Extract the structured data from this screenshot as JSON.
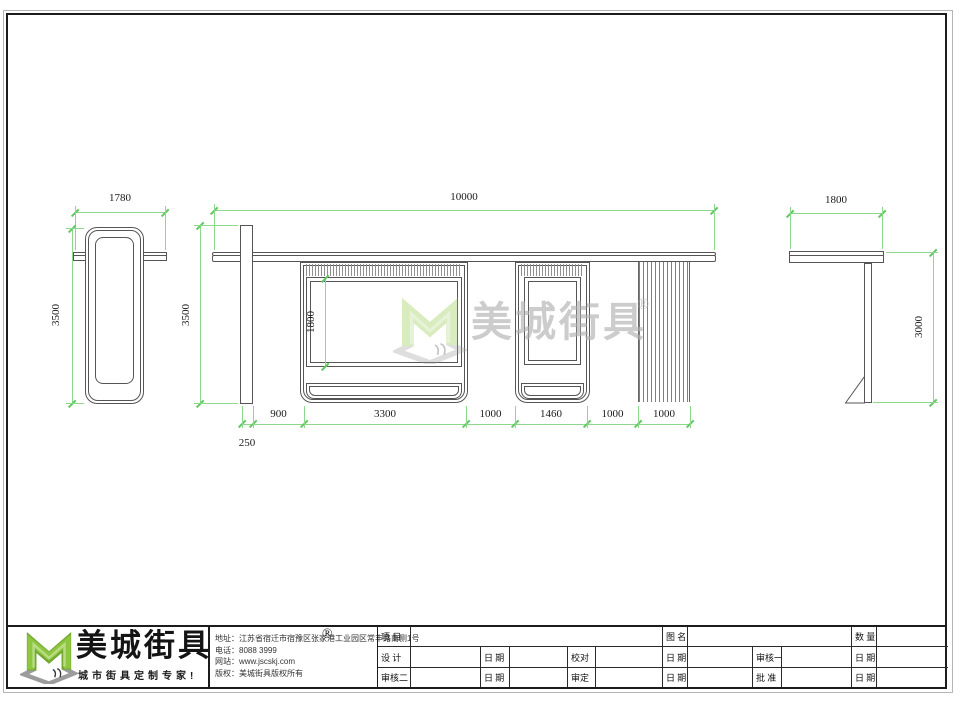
{
  "drawing": {
    "views": {
      "left": {
        "width_dim": "1780",
        "height_dim": "3500"
      },
      "front": {
        "width_dim": "10000",
        "height_dim": "3500",
        "ad_height_dim": "1800",
        "post_width_dim": "250",
        "bottom_dims": [
          "900",
          "3300",
          "1000",
          "1460",
          "1000",
          "1000"
        ]
      },
      "right": {
        "width_dim": "1800",
        "height_dim": "3000"
      }
    }
  },
  "watermark": {
    "brand": "美城街具",
    "reg": "®"
  },
  "footer": {
    "brand": "美城街具",
    "reg": "®",
    "tagline": "城市街具定制专家!",
    "contact_lines": [
      "地址：江苏省宿迁市宿豫区张家港工业园区常丰路南侧1号",
      "电话：8088 3999",
      "网站：www.jscskj.com",
      "版权：美城街具版权所有"
    ]
  },
  "titleblock": {
    "labels": {
      "project": "项 目",
      "name": "图 名",
      "qty": "数 量",
      "design": "设 计",
      "date": "日 期",
      "proofread": "校对",
      "review1": "审核一",
      "review2": "审核二",
      "approve": "审定",
      "ratify": "批 准"
    }
  },
  "colors": {
    "dimension_green": "#8cd98c",
    "drawing_line": "#555555",
    "logo_green": "#8dc63f",
    "logo_gray": "#9c9c9c"
  }
}
